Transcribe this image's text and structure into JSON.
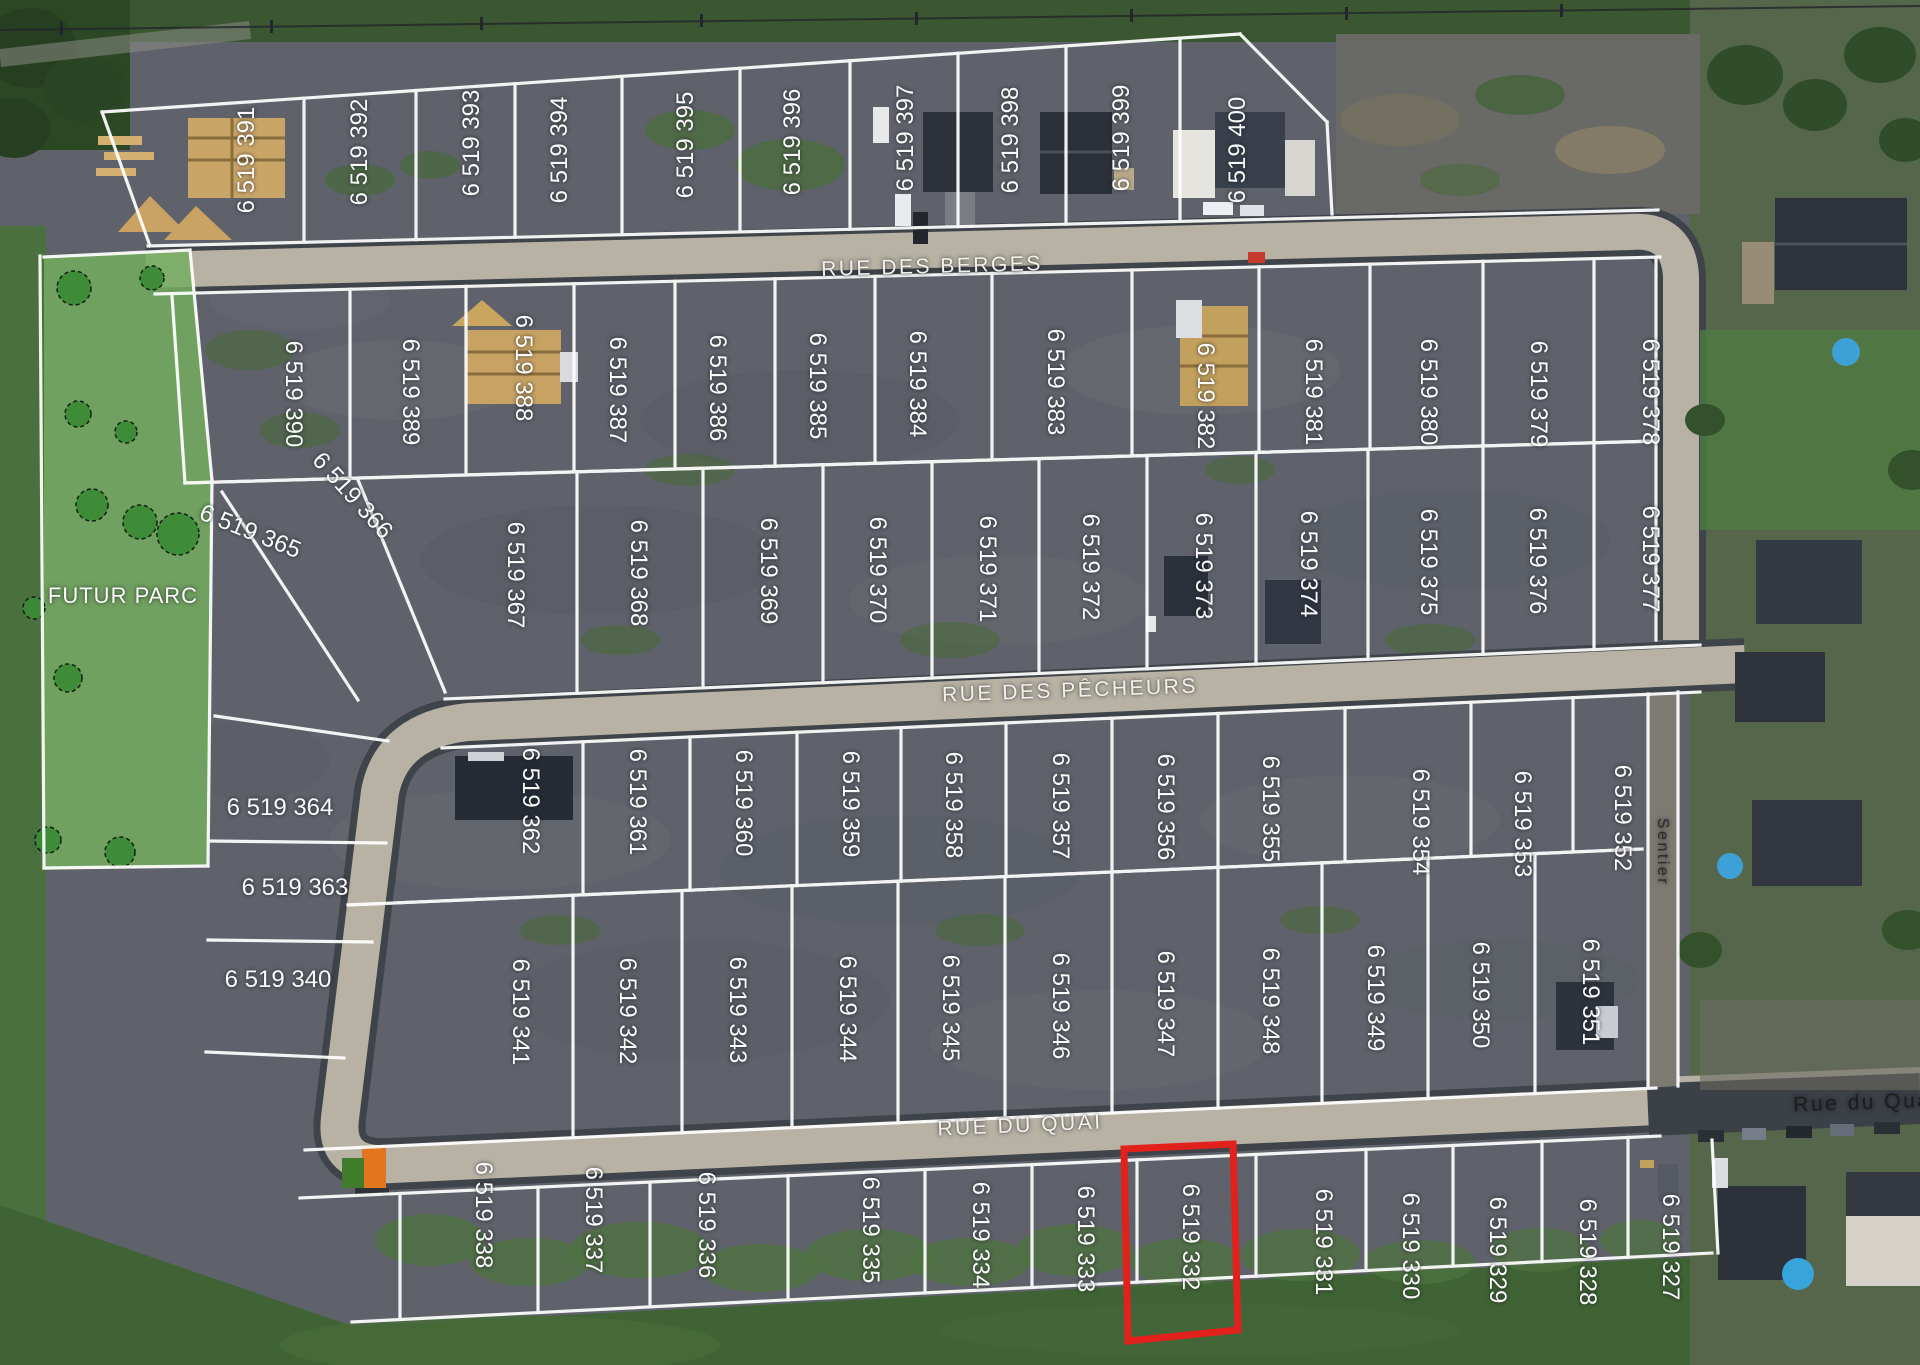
{
  "highlight": {
    "lot": "6 519 332",
    "color": "#e3211c"
  },
  "park": {
    "label": "FUTUR PARC"
  },
  "street_labels": [
    {
      "id": "rue-des-berges",
      "text": "RUE DES BERGES",
      "x": 932,
      "y": 267,
      "rot": -1.5,
      "fs": 21,
      "color": "#f2f0ea",
      "ls": 2.5
    },
    {
      "id": "rue-des-pecheurs",
      "text": "RUE DES PÊCHEURS",
      "x": 1070,
      "y": 691,
      "rot": -2,
      "fs": 21,
      "color": "#f2f0ea",
      "ls": 2.5
    },
    {
      "id": "rue-du-quai",
      "text": "RUE DU QUAI",
      "x": 1020,
      "y": 1126,
      "rot": -2.5,
      "fs": 21,
      "color": "#f2f0ea",
      "ls": 2.5
    },
    {
      "id": "rue-du-quai-east",
      "text": "Rue du Quai",
      "x": 1866,
      "y": 1103,
      "rot": -2,
      "fs": 21,
      "color": "#1d1d1d",
      "ls": 0
    },
    {
      "id": "sentier",
      "text": "Sentier",
      "x": 1662,
      "y": 852,
      "rot": 90,
      "fs": 16,
      "color": "#2c2c2c",
      "ls": 0
    },
    {
      "id": "futur-parc",
      "text": "FUTUR PARC",
      "x": 123,
      "y": 596,
      "rot": 0,
      "fs": 22,
      "color": "#fdfdfb",
      "ls": 1
    }
  ],
  "lots": [
    {
      "num": "6 519 391",
      "x": 247,
      "y": 160,
      "rot": -90
    },
    {
      "num": "6 519 392",
      "x": 360,
      "y": 152,
      "rot": -90
    },
    {
      "num": "6 519 393",
      "x": 472,
      "y": 143,
      "rot": -90
    },
    {
      "num": "6 519 394",
      "x": 560,
      "y": 150,
      "rot": -90
    },
    {
      "num": "6 519 395",
      "x": 686,
      "y": 145,
      "rot": -90
    },
    {
      "num": "6 519 396",
      "x": 793,
      "y": 142,
      "rot": -90
    },
    {
      "num": "6 519 397",
      "x": 906,
      "y": 138,
      "rot": -90
    },
    {
      "num": "6 519 398",
      "x": 1011,
      "y": 140,
      "rot": -90
    },
    {
      "num": "6 519 399",
      "x": 1122,
      "y": 138,
      "rot": -90
    },
    {
      "num": "6 519 400",
      "x": 1238,
      "y": 150,
      "rot": -90
    },
    {
      "num": "6 519 390",
      "x": 293,
      "y": 394,
      "rot": 90
    },
    {
      "num": "6 519 389",
      "x": 410,
      "y": 392,
      "rot": 90
    },
    {
      "num": "6 519 388",
      "x": 523,
      "y": 368,
      "rot": 90
    },
    {
      "num": "6 519 387",
      "x": 617,
      "y": 390,
      "rot": 90
    },
    {
      "num": "6 519 386",
      "x": 717,
      "y": 388,
      "rot": 90
    },
    {
      "num": "6 519 385",
      "x": 817,
      "y": 386,
      "rot": 90
    },
    {
      "num": "6 519 384",
      "x": 917,
      "y": 384,
      "rot": 90
    },
    {
      "num": "6 519 383",
      "x": 1055,
      "y": 382,
      "rot": 90
    },
    {
      "num": "6 519 382",
      "x": 1205,
      "y": 396,
      "rot": 90
    },
    {
      "num": "6 519 381",
      "x": 1313,
      "y": 392,
      "rot": 90
    },
    {
      "num": "6 519 380",
      "x": 1428,
      "y": 392,
      "rot": 90
    },
    {
      "num": "6 519 379",
      "x": 1538,
      "y": 394,
      "rot": 90
    },
    {
      "num": "6 519 378",
      "x": 1650,
      "y": 392,
      "rot": 90
    },
    {
      "num": "6 519 365",
      "x": 250,
      "y": 532,
      "rot": 22
    },
    {
      "num": "6 519 366",
      "x": 352,
      "y": 496,
      "rot": 48
    },
    {
      "num": "6 519 367",
      "x": 515,
      "y": 575,
      "rot": 90
    },
    {
      "num": "6 519 368",
      "x": 638,
      "y": 573,
      "rot": 90
    },
    {
      "num": "6 519 369",
      "x": 768,
      "y": 571,
      "rot": 90
    },
    {
      "num": "6 519 370",
      "x": 877,
      "y": 570,
      "rot": 90
    },
    {
      "num": "6 519 371",
      "x": 987,
      "y": 569,
      "rot": 90
    },
    {
      "num": "6 519 372",
      "x": 1090,
      "y": 567,
      "rot": 90
    },
    {
      "num": "6 519 373",
      "x": 1203,
      "y": 566,
      "rot": 90
    },
    {
      "num": "6 519 374",
      "x": 1308,
      "y": 564,
      "rot": 90
    },
    {
      "num": "6 519 375",
      "x": 1428,
      "y": 562,
      "rot": 90
    },
    {
      "num": "6 519 376",
      "x": 1537,
      "y": 561,
      "rot": 90
    },
    {
      "num": "6 519 377",
      "x": 1650,
      "y": 559,
      "rot": 90
    },
    {
      "num": "6 519 364",
      "x": 280,
      "y": 808,
      "rot": 0
    },
    {
      "num": "6 519 363",
      "x": 295,
      "y": 888,
      "rot": 0
    },
    {
      "num": "6 519 340",
      "x": 278,
      "y": 980,
      "rot": 0
    },
    {
      "num": "6 519 362",
      "x": 530,
      "y": 801,
      "rot": 90
    },
    {
      "num": "6 519 361",
      "x": 637,
      "y": 802,
      "rot": 90
    },
    {
      "num": "6 519 360",
      "x": 743,
      "y": 803,
      "rot": 90
    },
    {
      "num": "6 519 359",
      "x": 850,
      "y": 804,
      "rot": 90
    },
    {
      "num": "6 519 358",
      "x": 953,
      "y": 805,
      "rot": 90
    },
    {
      "num": "6 519 357",
      "x": 1060,
      "y": 806,
      "rot": 90
    },
    {
      "num": "6 519 356",
      "x": 1165,
      "y": 807,
      "rot": 90
    },
    {
      "num": "6 519 355",
      "x": 1270,
      "y": 809,
      "rot": 90
    },
    {
      "num": "6 519 354",
      "x": 1420,
      "y": 822,
      "rot": 90
    },
    {
      "num": "6 519 353",
      "x": 1522,
      "y": 824,
      "rot": 90
    },
    {
      "num": "6 519 352",
      "x": 1622,
      "y": 818,
      "rot": 90
    },
    {
      "num": "6 519 341",
      "x": 520,
      "y": 1012,
      "rot": 90
    },
    {
      "num": "6 519 342",
      "x": 627,
      "y": 1011,
      "rot": 90
    },
    {
      "num": "6 519 343",
      "x": 737,
      "y": 1010,
      "rot": 90
    },
    {
      "num": "6 519 344",
      "x": 847,
      "y": 1009,
      "rot": 90
    },
    {
      "num": "6 519 345",
      "x": 950,
      "y": 1008,
      "rot": 90
    },
    {
      "num": "6 519 346",
      "x": 1060,
      "y": 1006,
      "rot": 90
    },
    {
      "num": "6 519 347",
      "x": 1165,
      "y": 1004,
      "rot": 90
    },
    {
      "num": "6 519 348",
      "x": 1270,
      "y": 1001,
      "rot": 90
    },
    {
      "num": "6 519 349",
      "x": 1375,
      "y": 998,
      "rot": 90
    },
    {
      "num": "6 519 350",
      "x": 1480,
      "y": 995,
      "rot": 90
    },
    {
      "num": "6 519 351",
      "x": 1590,
      "y": 992,
      "rot": 90
    },
    {
      "num": "6 519 338",
      "x": 483,
      "y": 1215,
      "rot": 90
    },
    {
      "num": "6 519 337",
      "x": 593,
      "y": 1220,
      "rot": 90
    },
    {
      "num": "6 519 336",
      "x": 706,
      "y": 1225,
      "rot": 90
    },
    {
      "num": "6 519 335",
      "x": 870,
      "y": 1230,
      "rot": 90
    },
    {
      "num": "6 519 334",
      "x": 980,
      "y": 1235,
      "rot": 90
    },
    {
      "num": "6 519 333",
      "x": 1085,
      "y": 1239,
      "rot": 90
    },
    {
      "num": "6 519 332",
      "x": 1190,
      "y": 1237,
      "rot": 90
    },
    {
      "num": "6 519 331",
      "x": 1323,
      "y": 1242,
      "rot": 90
    },
    {
      "num": "6 519 330",
      "x": 1410,
      "y": 1246,
      "rot": 90
    },
    {
      "num": "6 519 329",
      "x": 1497,
      "y": 1250,
      "rot": 90
    },
    {
      "num": "6 519 328",
      "x": 1587,
      "y": 1252,
      "rot": 90
    },
    {
      "num": "6 519 327",
      "x": 1670,
      "y": 1247,
      "rot": 90
    }
  ]
}
